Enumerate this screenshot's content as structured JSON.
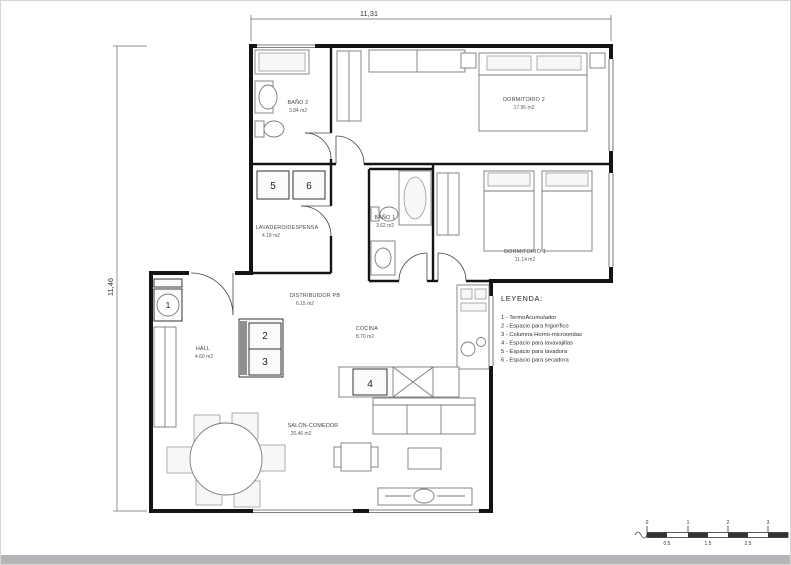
{
  "drawing": {
    "dim_top": "11,31",
    "dim_left": "11,46"
  },
  "rooms": {
    "dormitorio2": {
      "name": "DORMITORIO 2",
      "area": "17.96 m2"
    },
    "bano2": {
      "name": "BAÑO 2",
      "area": "3.84 m2"
    },
    "lavadero": {
      "name": "LAVADERO/DESPENSA",
      "area": "4.18 m2"
    },
    "bano1": {
      "name": "BAÑO 1",
      "area": "3.62 m2"
    },
    "dormitorio1": {
      "name": "DORMITORIO 1",
      "area": "11.14 m2"
    },
    "distribuidor": {
      "name": "DISTRIBUIDOR PB",
      "area": "6.15 m2"
    },
    "cocina": {
      "name": "COCINA",
      "area": "8.70 m2"
    },
    "hall": {
      "name": "HALL",
      "area": "4.60 m2"
    },
    "salon": {
      "name": "SALÓN-COMEDOR",
      "area": "20.46 m2"
    }
  },
  "legend": {
    "title": "LEYENDA:",
    "items": [
      "1 - TermoAcumulador",
      "2 - Espacio para frigorífico",
      "3 - Columna Horno-microondas",
      "4 - Espacio para lavavajillas",
      "5 - Espacio para lavadora",
      "6 - Espacio para secadora"
    ]
  },
  "markers": {
    "m1": "1",
    "m2": "2",
    "m3": "3",
    "m4": "4",
    "m5": "5",
    "m6": "6"
  },
  "scalebar": {
    "top": [
      "0",
      "1",
      "2",
      "3"
    ],
    "bottom": [
      "0.5",
      "1.5",
      "2.5"
    ]
  }
}
